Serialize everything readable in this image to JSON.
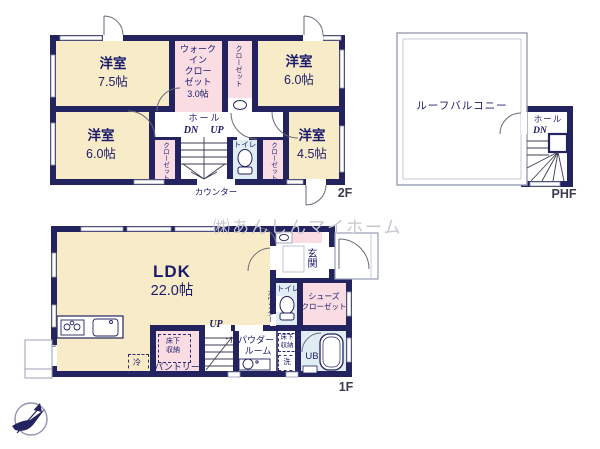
{
  "watermark": "㈱あんしんマイホーム",
  "floor2": {
    "label": "2F",
    "room_75": {
      "name": "洋室",
      "size": "7.5帖"
    },
    "wic_lines": [
      "ウォーク",
      "イン",
      "クロー",
      "ゼット",
      "3.0帖"
    ],
    "closet_top": "クローゼット",
    "room_60a": {
      "name": "洋室",
      "size": "6.0帖"
    },
    "room_60b": {
      "name": "洋室",
      "size": "6.0帖"
    },
    "closet_left": "クローゼット",
    "closet_right": "クローゼット",
    "hall": "ホール",
    "dn": "DN",
    "up": "UP",
    "toilet": "トイレ",
    "room_45": {
      "name": "洋室",
      "size": "4.5帖"
    },
    "counter": "カウンター"
  },
  "phf": {
    "label": "PHF",
    "roof_balcony": "ルーフバルコニー",
    "hall": "ホール",
    "dn": "DN"
  },
  "floor1": {
    "label": "1F",
    "ldk": {
      "name": "LDK",
      "size": "22.0帖"
    },
    "entrance": "玄関",
    "toilet": "トイレ",
    "counter": "カウンター",
    "shoes_lines": [
      "シューズ",
      "クローゼット"
    ],
    "up": "UP",
    "pantry": "パントリー",
    "underfloor_lines": [
      "床下",
      "収納"
    ],
    "powder_lines": [
      "パウダー",
      "ルーム"
    ],
    "washer": "洗",
    "fridge": "冷",
    "bath": "UB"
  },
  "colors": {
    "wall": "#23235f",
    "room_fill": "#f8ecc8",
    "closet_fill": "#f9dde2",
    "wet_fill": "#e0eef3",
    "label_text": "#1b1b6b"
  }
}
